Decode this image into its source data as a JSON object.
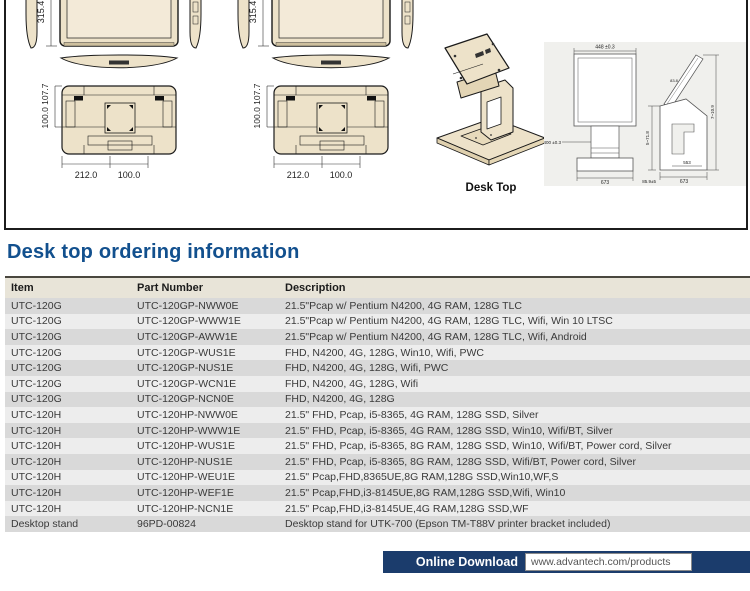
{
  "heading": {
    "title": "Desk top ordering information"
  },
  "colors": {
    "accent_blue": "#12508E",
    "footer_navy": "#1B3C6C",
    "beige": "#EDE2C9",
    "row_dark": "#D9D9D9",
    "row_light": "#EDEDED",
    "header_bg": "#E8E4D8"
  },
  "diagrams": {
    "monitor": {
      "height": "315.4",
      "vesa_vertical": "100.0 107.7",
      "bottom_width_1": "212.0",
      "bottom_width_2": "100.0"
    },
    "stand": {
      "caption": "Desk Top",
      "front": {
        "top": "448 ±0.3",
        "left": "400 ±0.3",
        "bottom": "673"
      },
      "side": {
        "angle": "83.8",
        "left": "5~71.8",
        "right": "7~10.9",
        "inner_bottom": "553",
        "bottom": "673",
        "bottom_left": "85.9±5"
      }
    }
  },
  "table": {
    "headers": [
      "Item",
      "Part Number",
      "Description"
    ],
    "rows": [
      {
        "item": "UTC-120G",
        "part": "UTC-120GP-NWW0E",
        "desc": "21.5\"Pcap w/ Pentium N4200, 4G RAM, 128G TLC"
      },
      {
        "item": "UTC-120G",
        "part": "UTC-120GP-WWW1E",
        "desc": "21.5\"Pcap w/ Pentium N4200, 4G RAM, 128G TLC, Wifi,  Win 10 LTSC"
      },
      {
        "item": "UTC-120G",
        "part": "UTC-120GP-AWW1E",
        "desc": "21.5\"Pcap w/ Pentium N4200, 4G RAM, 128G TLC, Wifi, Android"
      },
      {
        "item": "UTC-120G",
        "part": "UTC-120GP-WUS1E",
        "desc": "FHD, N4200, 4G, 128G, Win10, Wifi, PWC"
      },
      {
        "item": "UTC-120G",
        "part": "UTC-120GP-NUS1E",
        "desc": "FHD, N4200, 4G, 128G, Wifi, PWC"
      },
      {
        "item": "UTC-120G",
        "part": "UTC-120GP-WCN1E",
        "desc": "FHD, N4200, 4G, 128G, Wifi"
      },
      {
        "item": "UTC-120G",
        "part": "UTC-120GP-NCN0E",
        "desc": "FHD, N4200, 4G, 128G"
      },
      {
        "item": "UTC-120H",
        "part": "UTC-120HP-NWW0E",
        "desc": "21.5\" FHD, Pcap, i5-8365, 4G RAM, 128G SSD, Silver"
      },
      {
        "item": "UTC-120H",
        "part": "UTC-120HP-WWW1E",
        "desc": "21.5\" FHD, Pcap, i5-8365, 4G RAM, 128G SSD, Win10, Wifi/BT, Silver"
      },
      {
        "item": "UTC-120H",
        "part": "UTC-120HP-WUS1E",
        "desc": "21.5\" FHD, Pcap, i5-8365, 8G RAM, 128G SSD, Win10, Wifi/BT, Power cord, Silver"
      },
      {
        "item": "UTC-120H",
        "part": "UTC-120HP-NUS1E",
        "desc": "21.5\" FHD, Pcap, i5-8365, 8G RAM, 128G SSD, Wifi/BT, Power cord, Silver"
      },
      {
        "item": "UTC-120H",
        "part": "UTC-120HP-WEU1E",
        "desc": "21.5\" Pcap,FHD,8365UE,8G RAM,128G SSD,Win10,WF,S"
      },
      {
        "item": "UTC-120H",
        "part": "UTC-120HP-WEF1E",
        "desc": "21.5\" Pcap,FHD,i3-8145UE,8G RAM,128G SSD,Wifi, Win10"
      },
      {
        "item": "UTC-120H",
        "part": "UTC-120HP-NCN1E",
        "desc": "21.5\" Pcap,FHD,i3-8145UE,4G RAM,128G SSD,WF"
      },
      {
        "item": "Desktop stand",
        "part": "96PD-00824",
        "desc": "Desktop stand for UTK-700 (Epson TM-T88V printer bracket included)"
      }
    ]
  },
  "footer": {
    "download_label": "Online Download",
    "url": "www.advantech.com/products"
  }
}
